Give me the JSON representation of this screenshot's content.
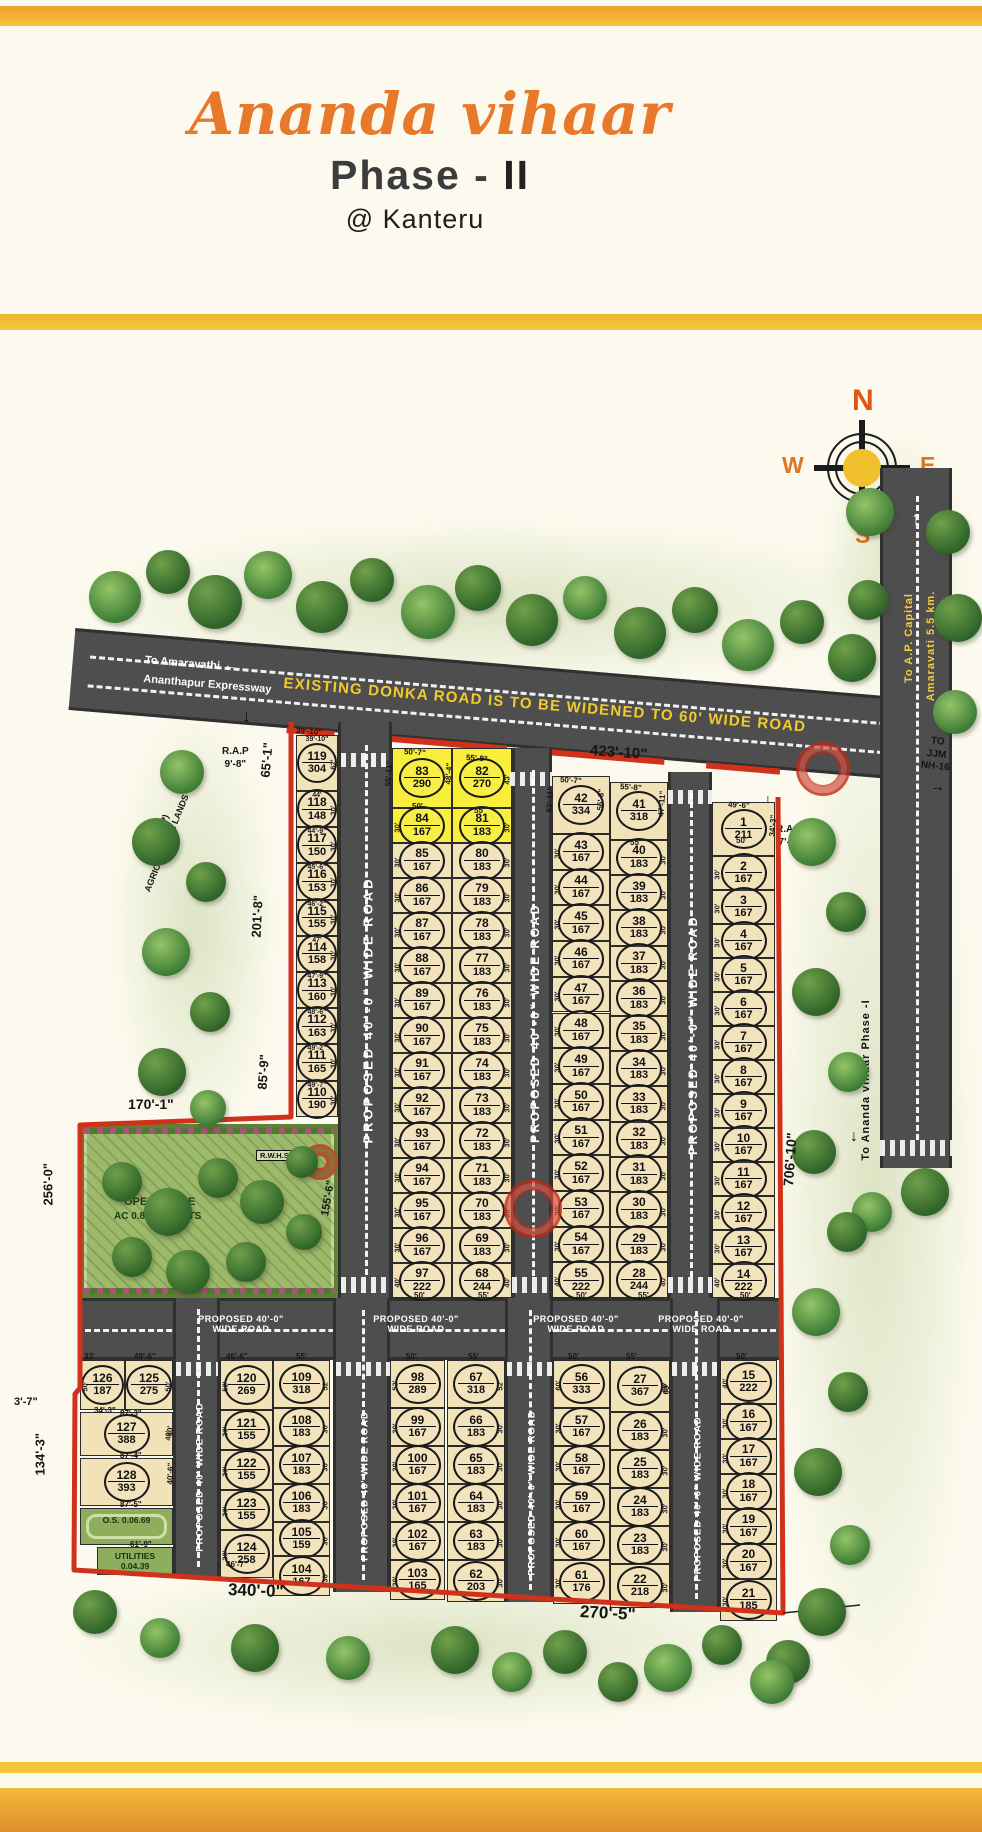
{
  "header": {
    "title": "Ananda vihaar",
    "phase": "Phase -",
    "phase_num": "II",
    "location": "@ Kanteru"
  },
  "compass": {
    "north": "N",
    "east": "E",
    "south": "S",
    "west": "W"
  },
  "roads": {
    "donka": "EXISTING  DONKA ROAD IS TO BE WIDENED TO 60' WIDE ROAD",
    "expressway": [
      "To Amaravathi",
      "Ananthapur Expressway"
    ],
    "capital": [
      "To A.P. Capital",
      "Amaravati 5.5 km."
    ],
    "nh16": [
      "TO",
      "JJM",
      "NH-16"
    ],
    "phase1": "To Ananda vihaar Phase -I",
    "proposed": "PROPOSED 40'-0\" WIDE ROAD",
    "proposed_short": "PROPOSED 40' WIDE ROAD"
  },
  "notes": {
    "amenities": [
      "AMENITIES",
      "FOR COMMERCIAL USE"
    ],
    "agricultural": [
      "D.NO.484(P)",
      "AGRICULTURAL LANDS"
    ],
    "rap_left": [
      "R.A.P",
      "9'-8\""
    ],
    "rap_right": [
      "R.A.P",
      "7'-2\""
    ]
  },
  "open_space": {
    "title": "OPEN SPACE",
    "area": "AC 0.81.06 CENTS",
    "rwhs": "R.W.H.S",
    "os_small": [
      "O.S.",
      "0.06.69"
    ],
    "utilities": [
      "UTILITIES",
      "0.04.39"
    ]
  },
  "plot_columns": {
    "A": [
      [
        119,
        304
      ],
      [
        118,
        148
      ],
      [
        117,
        150
      ],
      [
        116,
        153
      ],
      [
        115,
        155
      ],
      [
        114,
        158
      ],
      [
        113,
        160
      ],
      [
        112,
        163
      ],
      [
        111,
        165
      ],
      [
        110,
        190
      ]
    ],
    "BL": [
      [
        83,
        290
      ],
      [
        84,
        167
      ],
      [
        85,
        167
      ],
      [
        86,
        167
      ],
      [
        87,
        167
      ],
      [
        88,
        167
      ],
      [
        89,
        167
      ],
      [
        90,
        167
      ],
      [
        91,
        167
      ],
      [
        92,
        167
      ],
      [
        93,
        167
      ],
      [
        94,
        167
      ],
      [
        95,
        167
      ],
      [
        96,
        167
      ],
      [
        97,
        222
      ]
    ],
    "BR": [
      [
        82,
        270
      ],
      [
        81,
        183
      ],
      [
        80,
        183
      ],
      [
        79,
        183
      ],
      [
        78,
        183
      ],
      [
        77,
        183
      ],
      [
        76,
        183
      ],
      [
        75,
        183
      ],
      [
        74,
        183
      ],
      [
        73,
        183
      ],
      [
        72,
        183
      ],
      [
        71,
        183
      ],
      [
        70,
        183
      ],
      [
        69,
        183
      ],
      [
        68,
        244
      ]
    ],
    "CL": [
      [
        42,
        334
      ],
      [
        43,
        167
      ],
      [
        44,
        167
      ],
      [
        45,
        167
      ],
      [
        46,
        167
      ],
      [
        47,
        167
      ],
      [
        48,
        167
      ],
      [
        49,
        167
      ],
      [
        50,
        167
      ],
      [
        51,
        167
      ],
      [
        52,
        167
      ],
      [
        53,
        167
      ],
      [
        54,
        167
      ],
      [
        55,
        222
      ]
    ],
    "CR": [
      [
        41,
        318
      ],
      [
        40,
        183
      ],
      [
        39,
        183
      ],
      [
        38,
        183
      ],
      [
        37,
        183
      ],
      [
        36,
        183
      ],
      [
        35,
        183
      ],
      [
        34,
        183
      ],
      [
        33,
        183
      ],
      [
        32,
        183
      ],
      [
        31,
        183
      ],
      [
        30,
        183
      ],
      [
        29,
        183
      ],
      [
        28,
        244
      ]
    ],
    "D": [
      [
        1,
        211
      ],
      [
        2,
        167
      ],
      [
        3,
        167
      ],
      [
        4,
        167
      ],
      [
        5,
        167
      ],
      [
        6,
        167
      ],
      [
        7,
        167
      ],
      [
        8,
        167
      ],
      [
        9,
        167
      ],
      [
        10,
        167
      ],
      [
        11,
        167
      ],
      [
        12,
        167
      ],
      [
        13,
        167
      ],
      [
        14,
        222
      ]
    ],
    "E120": [
      [
        120,
        269
      ],
      [
        121,
        155
      ],
      [
        122,
        155
      ],
      [
        123,
        155
      ],
      [
        124,
        258
      ]
    ],
    "E109": [
      [
        109,
        318
      ],
      [
        108,
        183
      ],
      [
        107,
        183
      ],
      [
        106,
        183
      ],
      [
        105,
        159
      ],
      [
        104,
        167
      ]
    ],
    "F98": [
      [
        98,
        289
      ],
      [
        99,
        167
      ],
      [
        100,
        167
      ],
      [
        101,
        167
      ],
      [
        102,
        167
      ],
      [
        103,
        165
      ]
    ],
    "F67": [
      [
        67,
        318
      ],
      [
        66,
        183
      ],
      [
        65,
        183
      ],
      [
        64,
        183
      ],
      [
        63,
        183
      ],
      [
        62,
        203
      ]
    ],
    "G56": [
      [
        56,
        333
      ],
      [
        57,
        167
      ],
      [
        58,
        167
      ],
      [
        59,
        167
      ],
      [
        60,
        167
      ],
      [
        61,
        176
      ]
    ],
    "G27": [
      [
        27,
        367
      ],
      [
        26,
        183
      ],
      [
        25,
        183
      ],
      [
        24,
        183
      ],
      [
        23,
        183
      ],
      [
        22,
        218
      ]
    ],
    "H15": [
      [
        15,
        222
      ],
      [
        16,
        167
      ],
      [
        17,
        167
      ],
      [
        18,
        167
      ],
      [
        19,
        167
      ],
      [
        20,
        167
      ],
      [
        21,
        185
      ]
    ],
    "L126": [
      [
        126,
        187
      ]
    ],
    "L125": [
      [
        125,
        275
      ]
    ],
    "L127": [
      [
        127,
        388
      ]
    ],
    "L128": [
      [
        128,
        393
      ]
    ]
  },
  "amenity_plots": [
    81,
    82,
    83,
    84
  ],
  "top_labels_A": [
    "39'-10\"",
    "44'",
    "44'-9\"",
    "45'-6\"",
    "46'-2\"",
    "47'",
    "47'-9\"",
    "48'-6\"",
    "49'-2\"",
    "49'-7\""
  ],
  "boundary_dims": [
    [
      "423'-10\"",
      590,
      742,
      4,
      15
    ],
    [
      "65'-1\"",
      265,
      770,
      -85,
      13
    ],
    [
      "201'-8\"",
      256,
      930,
      -87,
      13
    ],
    [
      "85'-9\"",
      262,
      1082,
      -86,
      13
    ],
    [
      "170'-1\"",
      128,
      1096,
      0,
      14
    ],
    [
      "256'-0\"",
      48,
      1198,
      -90,
      13
    ],
    [
      "155'-6\"",
      325,
      1210,
      -80,
      11
    ],
    [
      "134'-3\"",
      40,
      1468,
      -90,
      13
    ],
    [
      "3'-7\"",
      14,
      1396,
      0,
      11
    ],
    [
      "340'-0\"",
      228,
      1580,
      2,
      17
    ],
    [
      "270'-5\"",
      580,
      1602,
      3,
      17
    ],
    [
      "706'-10\"",
      788,
      1178,
      -86,
      14
    ]
  ],
  "micro_dims": [
    [
      "50'-7\"",
      404,
      747,
      4,
      8
    ],
    [
      "55'-11\"",
      388,
      782,
      -86,
      8
    ],
    [
      "48'-4\"",
      448,
      780,
      -86,
      8
    ],
    [
      "55'-8\"",
      466,
      753,
      4,
      8
    ],
    [
      "50'",
      412,
      802,
      0,
      8
    ],
    [
      "55'",
      474,
      806,
      0,
      8
    ],
    [
      "50'-7\"",
      560,
      775,
      4,
      8
    ],
    [
      "63'-11\"",
      549,
      808,
      -86,
      8
    ],
    [
      "56'-3\"",
      600,
      806,
      -86,
      8
    ],
    [
      "55'-8\"",
      620,
      782,
      4,
      8
    ],
    [
      "55'",
      630,
      838,
      0,
      8
    ],
    [
      "47'-11\"",
      661,
      812,
      -86,
      8
    ],
    [
      "49'-6\"",
      728,
      800,
      3,
      8
    ],
    [
      "34'-3\"",
      772,
      832,
      -86,
      8
    ],
    [
      "50'",
      736,
      836,
      0,
      8
    ],
    [
      "50'",
      414,
      1291,
      0,
      8
    ],
    [
      "55'",
      478,
      1291,
      0,
      8
    ],
    [
      "50'",
      576,
      1291,
      0,
      8
    ],
    [
      "55'",
      638,
      1291,
      0,
      8
    ],
    [
      "50'",
      740,
      1291,
      0,
      8
    ],
    [
      "46'-6\"",
      226,
      1352,
      0,
      8
    ],
    [
      "55'",
      296,
      1352,
      0,
      8
    ],
    [
      "50'",
      406,
      1352,
      0,
      8
    ],
    [
      "55'",
      468,
      1352,
      0,
      8
    ],
    [
      "50'",
      568,
      1352,
      0,
      8
    ],
    [
      "55'",
      626,
      1352,
      0,
      8
    ],
    [
      "50'",
      736,
      1352,
      0,
      8
    ],
    [
      "60'",
      666,
      1390,
      -86,
      8
    ],
    [
      "33'",
      84,
      1352,
      0,
      8
    ],
    [
      "49'-6\"",
      134,
      1352,
      0,
      8
    ],
    [
      "34'-3\"",
      94,
      1406,
      0,
      8
    ],
    [
      "87'-3\"",
      120,
      1409,
      0,
      8
    ],
    [
      "87'-4\"",
      120,
      1451,
      0,
      8
    ],
    [
      "87'-5\"",
      120,
      1500,
      0,
      8
    ],
    [
      "61'-9\"",
      130,
      1540,
      0,
      8
    ],
    [
      "46'-7\"",
      226,
      1560,
      0,
      8
    ],
    [
      "40'",
      170,
      1432,
      -88,
      8
    ],
    [
      "40'-6\"",
      170,
      1480,
      -88,
      8
    ],
    [
      "39'-10\"",
      296,
      726,
      4,
      8
    ]
  ],
  "trees": [
    [
      115,
      597,
      26,
      1
    ],
    [
      168,
      572,
      22,
      0
    ],
    [
      215,
      602,
      27,
      0
    ],
    [
      268,
      575,
      24,
      1
    ],
    [
      322,
      607,
      26,
      0
    ],
    [
      372,
      580,
      22,
      0
    ],
    [
      428,
      612,
      27,
      1
    ],
    [
      478,
      588,
      23,
      0
    ],
    [
      532,
      620,
      26,
      0
    ],
    [
      585,
      598,
      22,
      1
    ],
    [
      640,
      633,
      26,
      0
    ],
    [
      695,
      610,
      23,
      0
    ],
    [
      748,
      645,
      26,
      1
    ],
    [
      802,
      622,
      22,
      0
    ],
    [
      852,
      658,
      24,
      0
    ],
    [
      870,
      512,
      24,
      1
    ],
    [
      948,
      532,
      22,
      0
    ],
    [
      958,
      618,
      24,
      0
    ],
    [
      868,
      600,
      20,
      0
    ],
    [
      955,
      712,
      22,
      1
    ],
    [
      925,
      1192,
      24,
      0
    ],
    [
      872,
      1212,
      20,
      1
    ],
    [
      812,
      842,
      24,
      1
    ],
    [
      846,
      912,
      20,
      0
    ],
    [
      816,
      992,
      24,
      0
    ],
    [
      848,
      1072,
      20,
      1
    ],
    [
      814,
      1152,
      22,
      0
    ],
    [
      847,
      1232,
      20,
      0
    ],
    [
      816,
      1312,
      24,
      1
    ],
    [
      848,
      1392,
      20,
      0
    ],
    [
      818,
      1472,
      24,
      0
    ],
    [
      850,
      1545,
      20,
      1
    ],
    [
      822,
      1612,
      24,
      0
    ],
    [
      788,
      1662,
      22,
      0
    ],
    [
      182,
      772,
      22,
      1
    ],
    [
      156,
      842,
      24,
      0
    ],
    [
      206,
      882,
      20,
      0
    ],
    [
      166,
      952,
      24,
      1
    ],
    [
      210,
      1012,
      20,
      0
    ],
    [
      162,
      1072,
      24,
      0
    ],
    [
      208,
      1108,
      18,
      1
    ],
    [
      122,
      1182,
      20,
      0
    ],
    [
      168,
      1212,
      24,
      0
    ],
    [
      218,
      1178,
      20,
      0
    ],
    [
      262,
      1202,
      22,
      0
    ],
    [
      132,
      1257,
      20,
      0
    ],
    [
      188,
      1272,
      22,
      0
    ],
    [
      246,
      1262,
      20,
      0
    ],
    [
      304,
      1232,
      18,
      0
    ],
    [
      302,
      1162,
      16,
      0
    ],
    [
      95,
      1612,
      22,
      0
    ],
    [
      160,
      1638,
      20,
      1
    ],
    [
      255,
      1648,
      24,
      0
    ],
    [
      348,
      1658,
      22,
      1
    ],
    [
      455,
      1650,
      24,
      0
    ],
    [
      512,
      1672,
      20,
      1
    ],
    [
      565,
      1652,
      22,
      0
    ],
    [
      668,
      1668,
      24,
      1
    ],
    [
      722,
      1645,
      20,
      0
    ],
    [
      772,
      1682,
      22,
      1
    ],
    [
      618,
      1682,
      20,
      0
    ]
  ],
  "seals": [
    [
      530,
      1206,
      26
    ],
    [
      820,
      766,
      24
    ]
  ],
  "crosswalks": [
    [
      341,
      753,
      46,
      14
    ],
    [
      510,
      772,
      42,
      14
    ],
    [
      668,
      790,
      44,
      14
    ],
    [
      341,
      1277,
      50,
      16
    ],
    [
      512,
      1277,
      40,
      16
    ],
    [
      668,
      1277,
      44,
      16
    ],
    [
      176,
      1362,
      42,
      14
    ],
    [
      336,
      1362,
      54,
      14
    ],
    [
      507,
      1362,
      46,
      14
    ],
    [
      672,
      1362,
      46,
      14
    ],
    [
      880,
      1140,
      72,
      16
    ]
  ],
  "colors": {
    "accent_orange": "#e8782a",
    "stripe_yellow": "#f2c53a",
    "stripe_orange": "#f0a22e",
    "road_gray": "#4e4e4e",
    "plot_cream": "#f2e2b8",
    "amenity_yellow": "#f8ee3b",
    "boundary_red": "#d0311a",
    "park_green": "#9db96a"
  }
}
